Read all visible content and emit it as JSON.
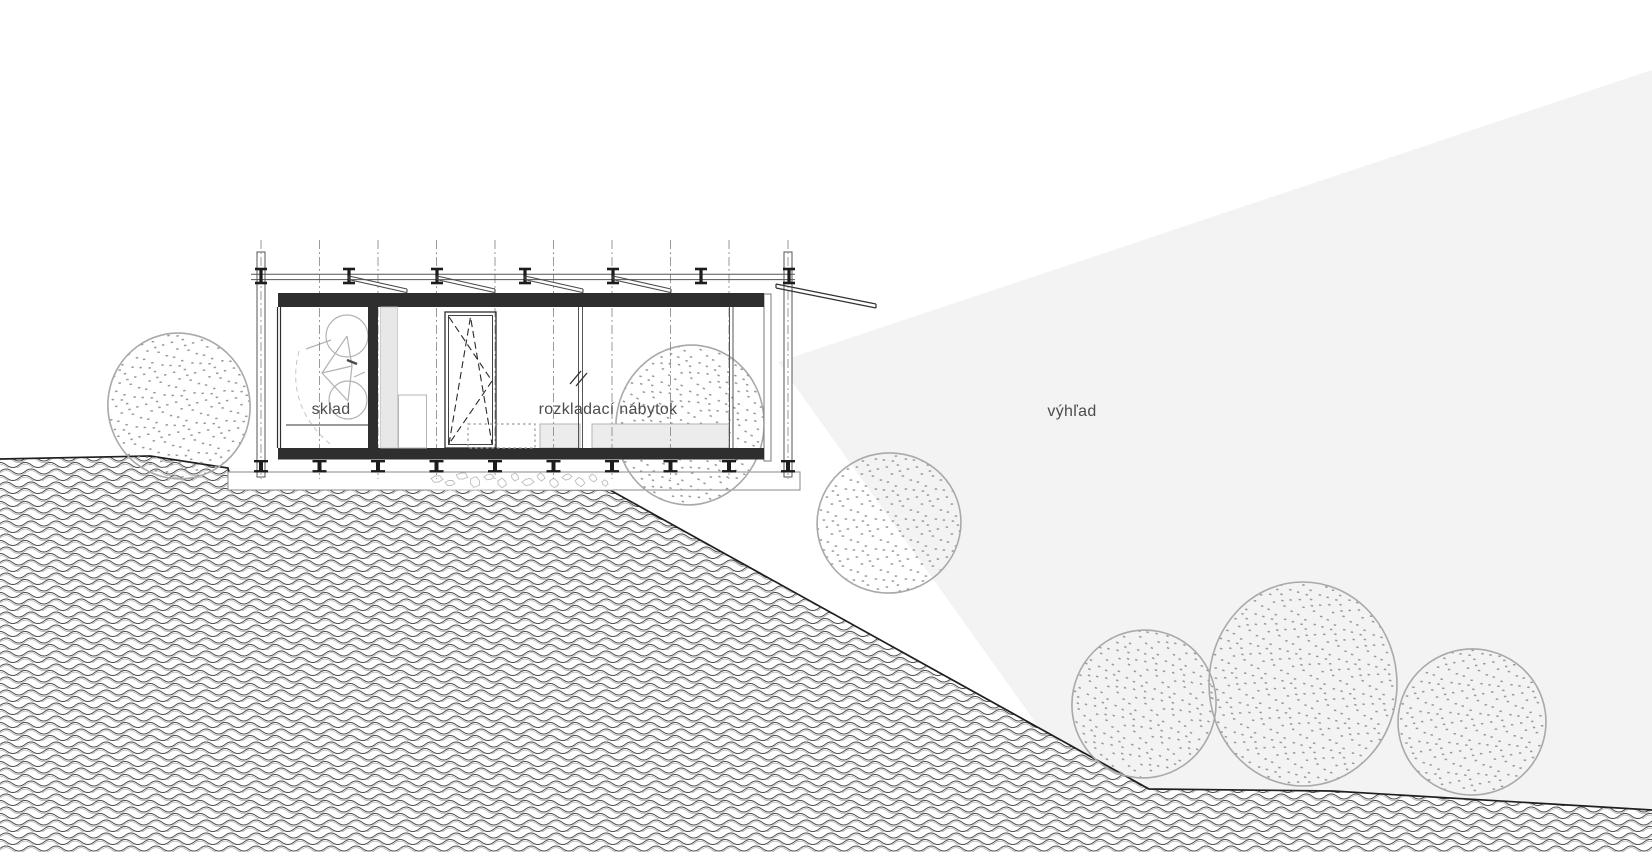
{
  "labels": {
    "storage": "sklad",
    "folding_furniture": "rozkladací nábytok",
    "view": "výhľad"
  },
  "label_positions": {
    "storage": {
      "x": 331,
      "y": 410
    },
    "folding_furniture": {
      "x": 608,
      "y": 410
    },
    "view": {
      "x": 1072,
      "y": 412
    }
  },
  "colors": {
    "background": "#ffffff",
    "view_cone": "#f3f3f3",
    "dark_fill": "#2e2e2e",
    "structure_line": "#555555",
    "metal": "#1c1c1c",
    "light_panel": "#e8e8e8",
    "slab_fill": "#ececec",
    "slab_stroke": "#b3b3b3",
    "tree_stroke": "#a9a9a9",
    "stipple_dot": "#989898",
    "hatch_dark": "#4a4a4a",
    "hatch_light": "#a6a6a6",
    "terrain_line": "#1f1f1f",
    "grid_line": "#909090",
    "stone_stroke": "#bdbdbd",
    "bike_stroke": "#b3b3b3",
    "label_color": "#4c4c4c"
  },
  "drawing": {
    "canvas": {
      "w": 1652,
      "h": 852
    },
    "view_cone": {
      "points": [
        [
          778,
          362
        ],
        [
          1652,
          70
        ],
        [
          1652,
          852
        ],
        [
          1128,
          852
        ]
      ]
    },
    "terrain": {
      "surface": [
        [
          0,
          459
        ],
        [
          150,
          456
        ],
        [
          228,
          468
        ],
        [
          233,
          489
        ],
        [
          610,
          490
        ],
        [
          1149,
          789
        ],
        [
          1332,
          791
        ],
        [
          1652,
          810
        ]
      ]
    },
    "foundation": {
      "strip": [
        228,
        472,
        800,
        490
      ],
      "stones_area": [
        430,
        472,
        613,
        490
      ],
      "stones": [
        [
          437,
          479,
          6
        ],
        [
          450,
          483,
          5
        ],
        [
          462,
          476,
          6
        ],
        [
          475,
          482,
          7
        ],
        [
          489,
          477,
          5
        ],
        [
          502,
          483,
          6
        ],
        [
          515,
          477,
          5
        ],
        [
          528,
          482,
          6
        ],
        [
          541,
          477,
          5
        ],
        [
          554,
          483,
          6
        ],
        [
          567,
          477,
          5
        ],
        [
          580,
          482,
          6
        ],
        [
          593,
          478,
          5
        ],
        [
          605,
          483,
          4
        ]
      ]
    },
    "trees_back": [
      {
        "cx": 690,
        "cy": 425,
        "rx": 74,
        "ry": 80,
        "rot": 8
      }
    ],
    "trees": [
      {
        "cx": 179,
        "cy": 406,
        "rx": 71,
        "ry": 73,
        "rot": -14
      },
      {
        "cx": 889,
        "cy": 523,
        "rx": 72,
        "ry": 70,
        "rot": -10
      },
      {
        "cx": 1144,
        "cy": 704,
        "rx": 72,
        "ry": 74,
        "rot": 12
      },
      {
        "cx": 1303,
        "cy": 684,
        "rx": 94,
        "ry": 102,
        "rot": 0
      },
      {
        "cx": 1472,
        "cy": 722,
        "rx": 74,
        "ry": 73,
        "rot": -8
      }
    ],
    "building": {
      "grid": {
        "xs": [
          261,
          319.5,
          378,
          436.5,
          495,
          553.5,
          612,
          670.5,
          729,
          788
        ],
        "top": 240,
        "bottom": 479
      },
      "clamps": {
        "xs": [
          261,
          349,
          437,
          525,
          613,
          701,
          789
        ],
        "y_top": 269,
        "y_bot": 283,
        "flange_w": 12
      },
      "rail": {
        "x1": 251,
        "x2": 795,
        "y1": 274.2,
        "y2": 279.6
      },
      "louvers": {
        "starts": [
          349,
          437,
          525,
          613
        ],
        "dx": 58,
        "dy": 13,
        "y": 276,
        "gap": 3.6
      },
      "flap": {
        "x1": 776,
        "y1": 284,
        "x2": 876,
        "y2": 304,
        "gap": 4
      },
      "columns": [
        [
          257,
          252,
          265,
          477
        ],
        [
          784,
          252,
          792,
          477
        ]
      ],
      "roof_band": [
        278,
        293,
        764,
        307
      ],
      "floor_band": [
        278,
        448,
        764,
        459.5
      ],
      "feet": {
        "xs": [
          261,
          319.5,
          378,
          436.5,
          495,
          553.5,
          612,
          670.5,
          729,
          788
        ],
        "y_top": 460,
        "y_bot": 472.5,
        "flange_w": 14
      },
      "sklad_bg": [
        281,
        307,
        368,
        448
      ],
      "sklad_glass_x": [
        277.5,
        280.5
      ],
      "dark_wall": [
        368,
        307,
        378,
        448
      ],
      "gray_panel": [
        380.5,
        307,
        397.5,
        448
      ],
      "cabinet": [
        398.5,
        395,
        426.5,
        448
      ],
      "shelf": [
        286,
        425,
        368,
        425
      ],
      "window": {
        "outer": [
          445,
          312,
          496,
          448
        ],
        "inner": [
          448.5,
          315.5,
          492.5,
          444.5
        ],
        "dash1": "M449,444 L470.5,317 L492,444",
        "dash2": "M449,317 L492,381 L449,444"
      },
      "mullions_x": [
        578.5,
        582.5,
        729.5,
        733
      ],
      "right_strip": [
        764,
        294,
        771,
        461
      ],
      "dotted_furniture": [
        468,
        424,
        535,
        448
      ],
      "slabs": [
        [
          540,
          424,
          580,
          448
        ],
        [
          592,
          424,
          729,
          448
        ]
      ],
      "glazing_mark": [
        "M570,384 L581,371",
        "M576,386 L587,373"
      ],
      "bike": {
        "wheels": [
          [
            347,
            336,
            21
          ],
          [
            348,
            400,
            19
          ]
        ],
        "frame": "M347,336 L322,373 L348,401 M322,373 L352,366 L347,336 M352,366 L348,401",
        "handlebar": "M331,340 L306,349",
        "seat": "M354,377 L365,372",
        "pedal": "M347,360 L357,364",
        "swing_arc": "M299,351 Q285,405 330,444"
      }
    }
  }
}
